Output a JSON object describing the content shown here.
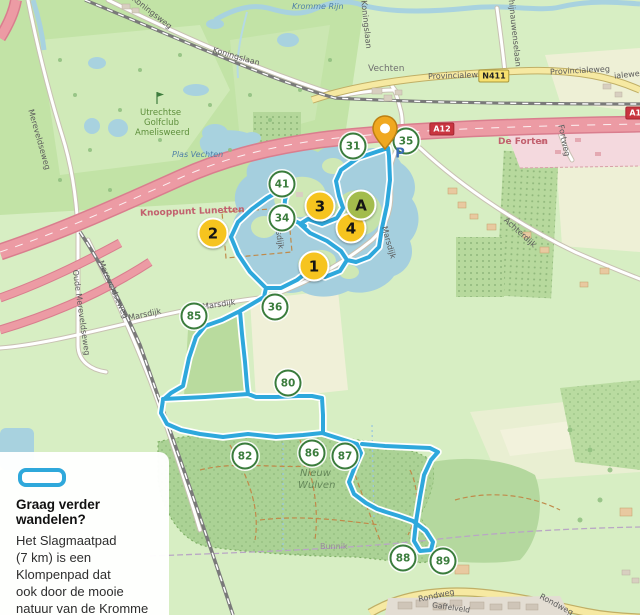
{
  "legend": {
    "title": "Graag verder wandelen?",
    "lines": [
      "Het Slagmaatpad",
      "(7 km) is een",
      "Klompenpad dat",
      "ook door de mooie",
      "natuur van de Kromme",
      "Rijnstreek gaat."
    ]
  },
  "markers": {
    "route": [
      {
        "label": "1"
      },
      {
        "label": "2"
      },
      {
        "label": "3"
      },
      {
        "label": "4"
      },
      {
        "label": "A"
      }
    ],
    "junctions": [
      {
        "label": "31"
      },
      {
        "label": "34"
      },
      {
        "label": "35"
      },
      {
        "label": "36"
      },
      {
        "label": "41"
      },
      {
        "label": "80"
      },
      {
        "label": "82"
      },
      {
        "label": "85"
      },
      {
        "label": "86"
      },
      {
        "label": "87"
      },
      {
        "label": "88"
      },
      {
        "label": "89"
      }
    ],
    "parking_label": "P"
  },
  "badges": {
    "motorway": "A12",
    "motorway_right": "A12",
    "provincial": "N411"
  },
  "labels": {
    "koningsweg": "Koningsweg",
    "koningslaan": "Koningslaan",
    "koningslaan_vertical": "Koningslaan",
    "kromme_rijn": "Kromme Rijn",
    "rhijnauwenselaan": "Rhijnauwenselaan",
    "mereveldseweg": "Mereveldseweg",
    "mereveldseweg2": "Mereveldseweg",
    "oude_mereveldseweg": "Oude Mereveldseweg",
    "vechten": "Vechten",
    "provincialeweg": "Provincialeweg",
    "provincialeweg2": "Provincialeweg",
    "provincialeweg_cut": "ialeweg",
    "de_forten": "De Forten",
    "fortweg": "Fortweg",
    "knooppunt_lunetten": "Knooppunt Lunetten",
    "golfclub_line1": "Utrechtse",
    "golfclub_line2": "Golfclub",
    "golfclub_line3": "Amelisweerd",
    "plas_vechten": "Plas Vechten",
    "marsdijk": "Marsdijk",
    "achterdijk": "Achterdijk",
    "nieuw_wulven_1": "Nieuw",
    "nieuw_wulven_2": "Wulven",
    "bunnik": "Bunnik",
    "rondweg": "Rondweg",
    "gaffelveld": "Gaffelveld"
  },
  "colors": {
    "route": "#2ea8dc",
    "route_marker": "#f6c41f",
    "poi_marker": "#a3bc4c",
    "junction_green": "#3a7c3c",
    "motorway": "#ec9ba4",
    "provincial_road": "#f6e9a2",
    "water": "#a8d2df",
    "forest": "#abd295",
    "pin": "#f0a820"
  }
}
